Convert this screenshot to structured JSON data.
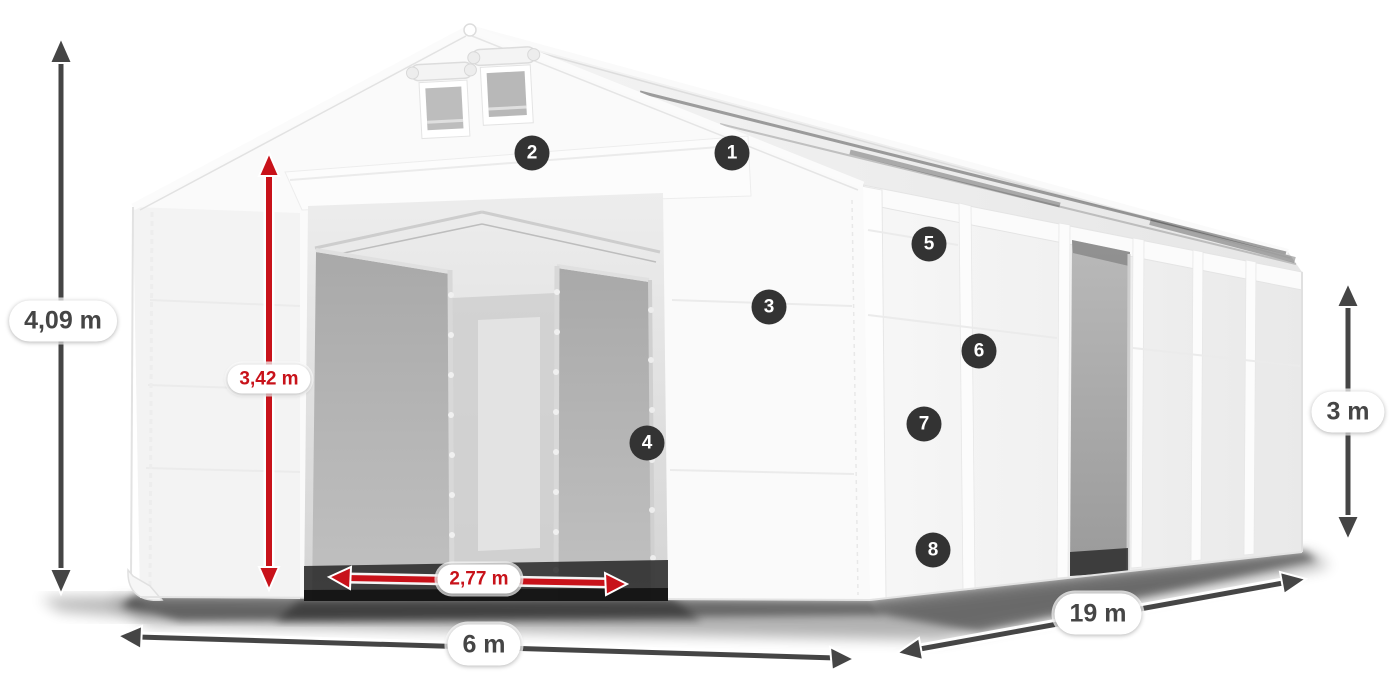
{
  "diagram": {
    "subject": "white tarpaulin storage tent with dimension annotations",
    "badges": [
      {
        "label": "1"
      },
      {
        "label": "2"
      },
      {
        "label": "3"
      },
      {
        "label": "4"
      },
      {
        "label": "5"
      },
      {
        "label": "6"
      },
      {
        "label": "7"
      },
      {
        "label": "8"
      }
    ],
    "dimensions": {
      "total_height": {
        "label": "4,09 m"
      },
      "clearance_height": {
        "label": "3,42 m"
      },
      "entrance_width": {
        "label": "2,77 m"
      },
      "width": {
        "label": "6 m"
      },
      "length": {
        "label": "19 m"
      },
      "side_height": {
        "label": "3 m"
      }
    },
    "colors": {
      "dimension_red": "#c8121a",
      "dimension_gray": "#454545",
      "badge_bg": "#333333",
      "badge_text": "#ffffff"
    }
  }
}
